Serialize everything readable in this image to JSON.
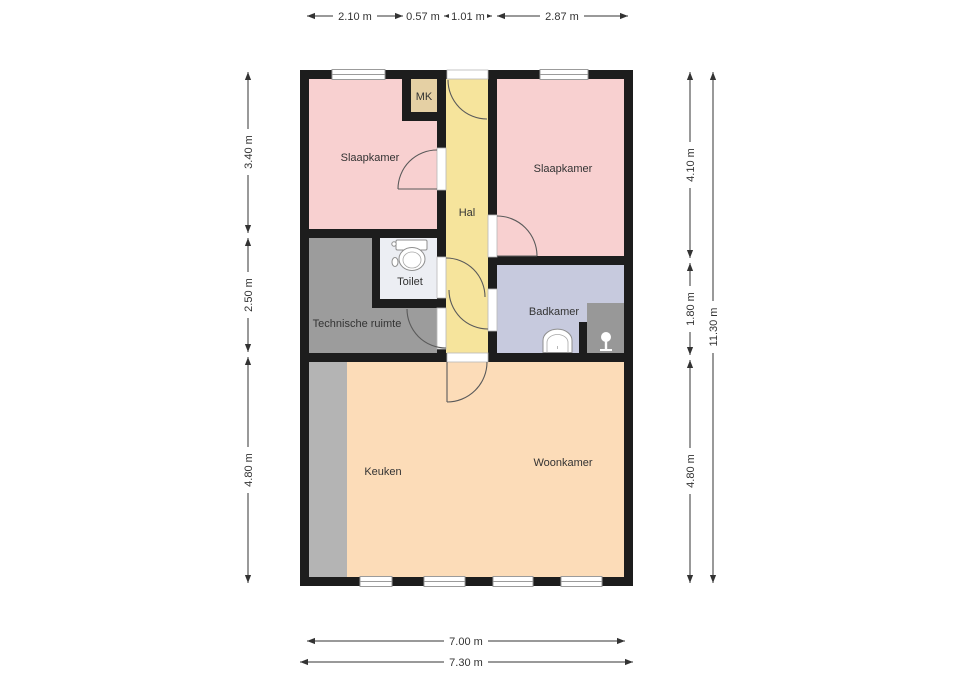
{
  "page": {
    "type": "floor-plan",
    "background": "#ffffff"
  },
  "colors": {
    "wall": "#1d1d1d",
    "bedroom": "#f8d0d0",
    "hall": "#f6e49c",
    "meter_closet": "#e5d0a4",
    "toilet_room": "#eceef3",
    "technical_room": "#9c9c9c",
    "bathroom": "#c7cade",
    "living_kitchen": "#fcdcb8",
    "kitchen_counter": "#b4b4b4",
    "shower": "#989898"
  },
  "rooms": [
    {
      "id": "slaapkamer-left",
      "label": "Slaapkamer"
    },
    {
      "id": "mk",
      "label": "MK"
    },
    {
      "id": "hal",
      "label": "Hal"
    },
    {
      "id": "slaapkamer-right",
      "label": "Slaapkamer"
    },
    {
      "id": "toilet",
      "label": "Toilet"
    },
    {
      "id": "technische-ruimte",
      "label": "Technische ruimte"
    },
    {
      "id": "badkamer",
      "label": "Badkamer"
    },
    {
      "id": "keuken",
      "label": "Keuken"
    },
    {
      "id": "woonkamer",
      "label": "Woonkamer"
    }
  ],
  "dimensions": {
    "top": [
      {
        "value": "2.10 m"
      },
      {
        "value": "0.57 m"
      },
      {
        "value": "1.01 m"
      },
      {
        "value": "2.87 m"
      }
    ],
    "left": [
      {
        "value": "3.40 m"
      },
      {
        "value": "2.50 m"
      },
      {
        "value": "4.80 m"
      }
    ],
    "right": [
      {
        "value": "4.10 m"
      },
      {
        "value": "1.80 m"
      },
      {
        "value": "4.80 m"
      }
    ],
    "right_total": {
      "value": "11.30 m"
    },
    "bottom_inner": {
      "value": "7.00 m"
    },
    "bottom_outer": {
      "value": "7.30 m"
    }
  },
  "fixtures": [
    "toilet-icon",
    "sink-icon",
    "shower-icon",
    "kitchen-counter"
  ]
}
